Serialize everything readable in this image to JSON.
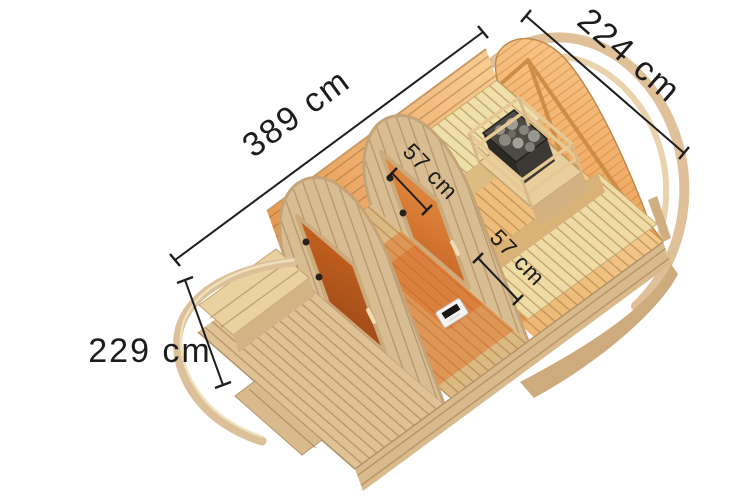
{
  "figure": {
    "title": "Barrel sauna dimension diagram",
    "subject": "wooden barrel garden sauna with porch, cutaway top view",
    "units": "cm"
  },
  "dimensions": {
    "length": {
      "label": "389 cm"
    },
    "rear_width": {
      "label": "224 cm"
    },
    "front_width": {
      "label": "229 cm"
    },
    "left_bench_depth": {
      "label": "57 cm"
    },
    "right_bench_depth": {
      "label": "57 cm"
    }
  },
  "illustration_parts": [
    "roof-arc",
    "gable-wall",
    "left-wall",
    "rear-room-floor",
    "left-bench",
    "right-bench",
    "sauna-heater",
    "heater-stones",
    "rear-partition",
    "rear-sauna-door",
    "middle-room-floor",
    "ventilation-control",
    "front-partition",
    "front-sauna-door",
    "porch-floor",
    "porch-bench",
    "entrance-arch",
    "front-step",
    "side-wall"
  ],
  "colors": {
    "background": "#ffffff",
    "dimension_ink": "#1d1d1d",
    "wood_light": "#e3c79c",
    "wood_pale": "#eedca6",
    "wood_warm": "#e8a95e",
    "door_glass_amber": "#d97c33",
    "heater_stone_grey": "#8f8c84"
  }
}
